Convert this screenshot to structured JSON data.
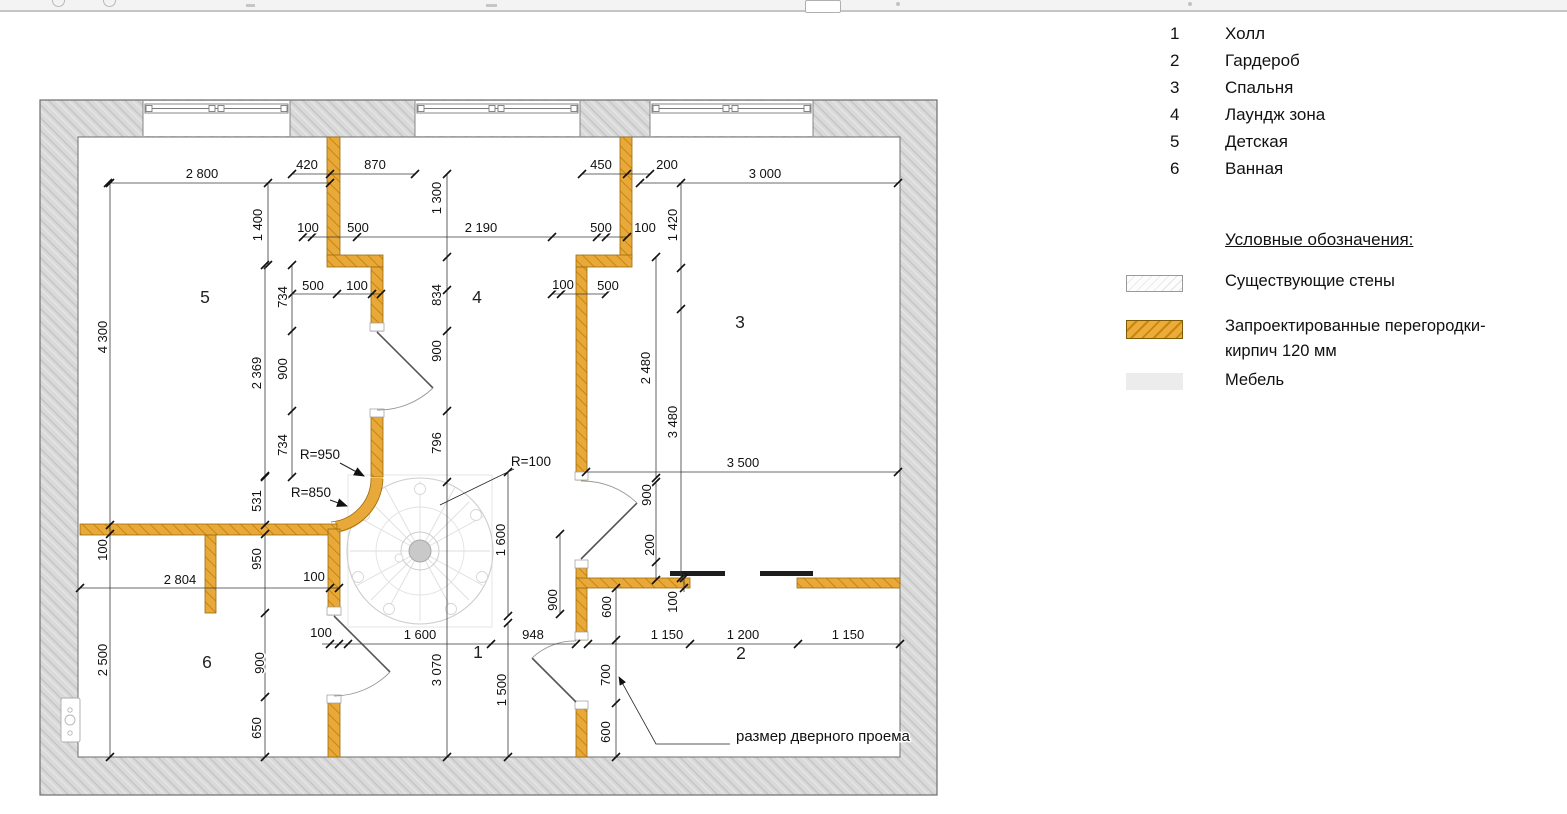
{
  "legend": {
    "rooms": [
      {
        "num": "1",
        "label": "Холл"
      },
      {
        "num": "2",
        "label": "Гардероб"
      },
      {
        "num": "3",
        "label": "Спальня"
      },
      {
        "num": "4",
        "label": "Лаундж зона"
      },
      {
        "num": "5",
        "label": "Детская"
      },
      {
        "num": "6",
        "label": "Ванная"
      }
    ],
    "symbols_title": "Условные обозначения:",
    "symbols": [
      {
        "label": "Существующие стены",
        "type": "existing-walls"
      },
      {
        "label": "Запроектированные перегородки-",
        "label2": "кирпич 120 мм",
        "type": "new-partitions"
      },
      {
        "label": "Мебель",
        "type": "furniture"
      }
    ],
    "colors": {
      "new_wall": "#E8A93A",
      "new_wall_hatch": "#C8860A",
      "existing_wall": "#D9D9D9",
      "furniture": "#ECECEC"
    }
  },
  "plan": {
    "room_numbers": [
      {
        "t": "5",
        "x": 205,
        "y": 303
      },
      {
        "t": "4",
        "x": 477,
        "y": 303
      },
      {
        "t": "3",
        "x": 740,
        "y": 328
      },
      {
        "t": "6",
        "x": 207,
        "y": 668
      },
      {
        "t": "1",
        "x": 478,
        "y": 658
      },
      {
        "t": "2",
        "x": 741,
        "y": 659
      }
    ],
    "annotations": [
      {
        "t": "R=950",
        "x": 320,
        "y": 459
      },
      {
        "t": "R=850",
        "x": 311,
        "y": 497
      },
      {
        "t": "R=100",
        "x": 531,
        "y": 466
      }
    ],
    "door_note": "размер дверного проема",
    "dimensions": [
      {
        "t": "2 800",
        "x": 202,
        "y": 178,
        "r": 0
      },
      {
        "t": "420",
        "x": 307,
        "y": 169,
        "r": 0
      },
      {
        "t": "870",
        "x": 375,
        "y": 169,
        "r": 0
      },
      {
        "t": "450",
        "x": 601,
        "y": 169,
        "r": 0
      },
      {
        "t": "200",
        "x": 667,
        "y": 169,
        "r": 0
      },
      {
        "t": "3 000",
        "x": 765,
        "y": 178,
        "r": 0
      },
      {
        "t": "1 400",
        "x": 262,
        "y": 225,
        "r": 1
      },
      {
        "t": "1 300",
        "x": 441,
        "y": 198,
        "r": 1
      },
      {
        "t": "1 420",
        "x": 677,
        "y": 225,
        "r": 1
      },
      {
        "t": "100",
        "x": 308,
        "y": 232,
        "r": 0
      },
      {
        "t": "500",
        "x": 358,
        "y": 232,
        "r": 0
      },
      {
        "t": "2 190",
        "x": 481,
        "y": 232,
        "r": 0
      },
      {
        "t": "500",
        "x": 601,
        "y": 232,
        "r": 0
      },
      {
        "t": "100",
        "x": 645,
        "y": 232,
        "r": 0
      },
      {
        "t": "500",
        "x": 313,
        "y": 290,
        "r": 0
      },
      {
        "t": "100",
        "x": 357,
        "y": 290,
        "r": 0
      },
      {
        "t": "100",
        "x": 563,
        "y": 289,
        "r": 0
      },
      {
        "t": "500",
        "x": 608,
        "y": 290,
        "r": 0
      },
      {
        "t": "734",
        "x": 287,
        "y": 297,
        "r": 1
      },
      {
        "t": "834",
        "x": 441,
        "y": 295,
        "r": 1
      },
      {
        "t": "4 300",
        "x": 107,
        "y": 337,
        "r": 1
      },
      {
        "t": "2 369",
        "x": 261,
        "y": 373,
        "r": 1
      },
      {
        "t": "900",
        "x": 287,
        "y": 369,
        "r": 1
      },
      {
        "t": "900",
        "x": 441,
        "y": 351,
        "r": 1
      },
      {
        "t": "2 480",
        "x": 650,
        "y": 368,
        "r": 1
      },
      {
        "t": "734",
        "x": 287,
        "y": 445,
        "r": 1
      },
      {
        "t": "796",
        "x": 441,
        "y": 443,
        "r": 1
      },
      {
        "t": "3 480",
        "x": 677,
        "y": 422,
        "r": 1
      },
      {
        "t": "531",
        "x": 261,
        "y": 501,
        "r": 1
      },
      {
        "t": "3 500",
        "x": 743,
        "y": 467,
        "r": 0
      },
      {
        "t": "900",
        "x": 651,
        "y": 495,
        "r": 1
      },
      {
        "t": "100",
        "x": 107,
        "y": 550,
        "r": 1
      },
      {
        "t": "950",
        "x": 261,
        "y": 559,
        "r": 1
      },
      {
        "t": "200",
        "x": 654,
        "y": 545,
        "r": 1
      },
      {
        "t": "1 600",
        "x": 505,
        "y": 540,
        "r": 1
      },
      {
        "t": "2 804",
        "x": 180,
        "y": 584,
        "r": 0
      },
      {
        "t": "100",
        "x": 314,
        "y": 581,
        "r": 0
      },
      {
        "t": "900",
        "x": 557,
        "y": 600,
        "r": 1
      },
      {
        "t": "600",
        "x": 611,
        "y": 607,
        "r": 1
      },
      {
        "t": "100",
        "x": 677,
        "y": 602,
        "r": 1
      },
      {
        "t": "100",
        "x": 321,
        "y": 637,
        "r": 0
      },
      {
        "t": "1 600",
        "x": 420,
        "y": 639,
        "r": 0
      },
      {
        "t": "948",
        "x": 533,
        "y": 639,
        "r": 0
      },
      {
        "t": "1 150",
        "x": 667,
        "y": 639,
        "r": 0
      },
      {
        "t": "1 200",
        "x": 743,
        "y": 639,
        "r": 0
      },
      {
        "t": "1 150",
        "x": 848,
        "y": 639,
        "r": 0
      },
      {
        "t": "2 500",
        "x": 107,
        "y": 660,
        "r": 1
      },
      {
        "t": "900",
        "x": 264,
        "y": 663,
        "r": 1
      },
      {
        "t": "3 070",
        "x": 441,
        "y": 670,
        "r": 1
      },
      {
        "t": "1 500",
        "x": 506,
        "y": 690,
        "r": 1
      },
      {
        "t": "700",
        "x": 610,
        "y": 675,
        "r": 1
      },
      {
        "t": "650",
        "x": 261,
        "y": 728,
        "r": 1
      },
      {
        "t": "600",
        "x": 610,
        "y": 732,
        "r": 1
      }
    ]
  }
}
